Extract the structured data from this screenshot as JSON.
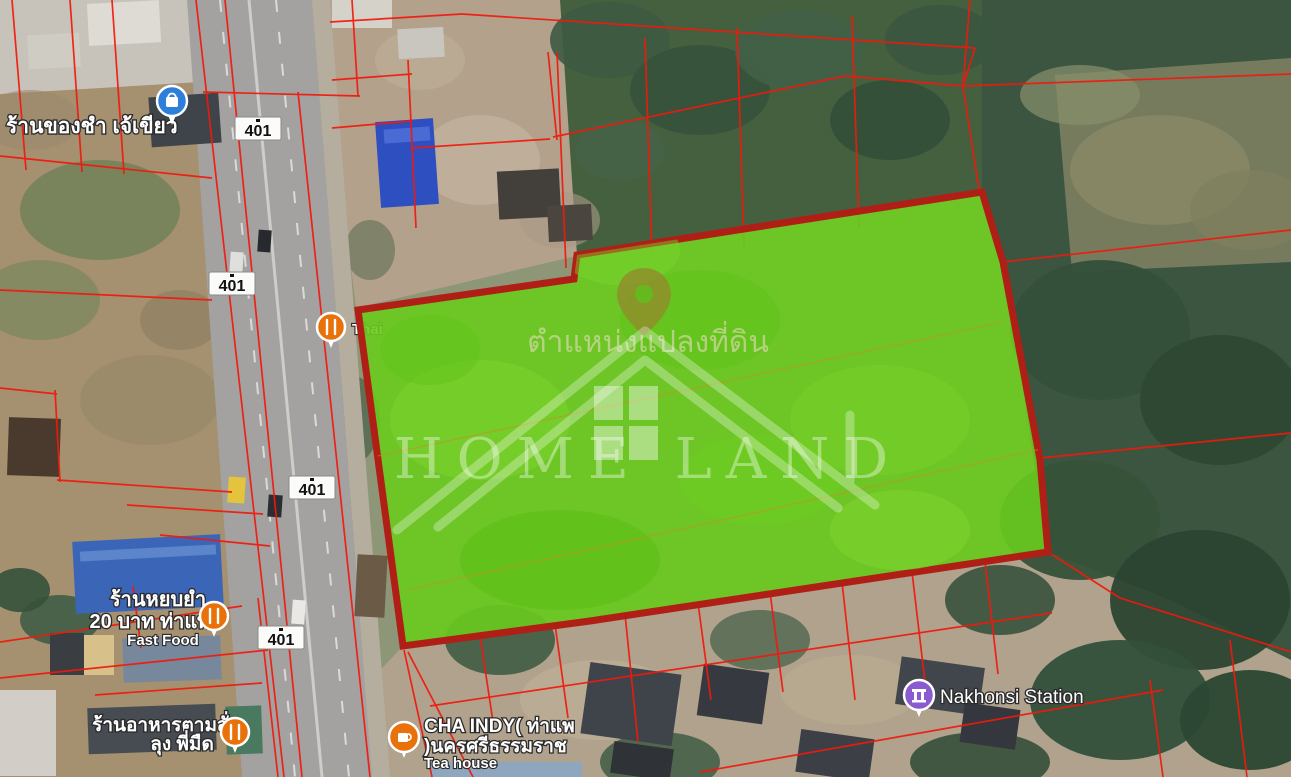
{
  "map": {
    "watermark": {
      "caption_thai": "ตำแหน่งแปลงที่ดิน",
      "brand": "HOME LAND"
    },
    "road_shields": [
      {
        "label": "401"
      },
      {
        "label": "401"
      },
      {
        "label": "401"
      },
      {
        "label": "401"
      }
    ],
    "places": {
      "grocery": {
        "name": "ร้านของชำ เจ้เขียว",
        "icon": "shopping-pin"
      },
      "thai_restaurant": {
        "name": "Thai",
        "icon": "restaurant-pin"
      },
      "fast_food": {
        "name_line1": "ร้านหยบยำ",
        "name_line2": "20 บาท ท่าแพ",
        "category": "Fast Food",
        "icon": "restaurant-pin"
      },
      "made_to_order": {
        "name_line1": "ร้านอาหารตามสั่ง",
        "name_line2": "ลุง พี่มืด",
        "icon": "restaurant-pin"
      },
      "tea_house": {
        "name_line1": "CHA INDY( ท่าแพ",
        "name_line2": ")นครศรีธรรมราช",
        "category": "Tea house",
        "icon": "cafe-pin"
      },
      "station": {
        "name": "Nakhonsi Station",
        "icon": "station-pin"
      }
    },
    "colors": {
      "plot_fill": "#69cb1d",
      "plot_border": "#b01f16",
      "parcel_line": "#f2180c",
      "shopping_pin": "#2e7fd9",
      "food_pin": "#e8710a",
      "station_pin": "#8a5ad0"
    }
  }
}
